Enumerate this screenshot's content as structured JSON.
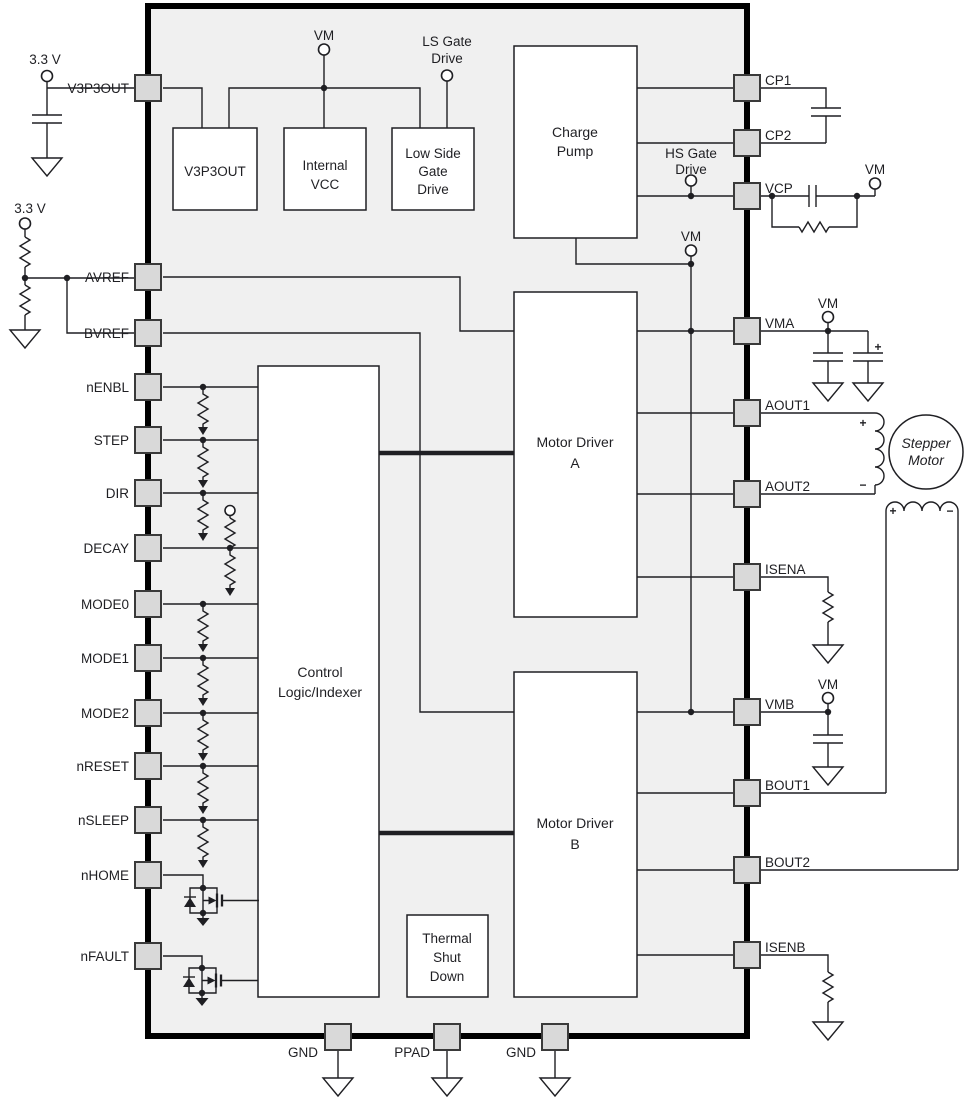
{
  "labels": {
    "v33": "3.3 V",
    "vm": "VM",
    "ls_gate": [
      "LS Gate",
      "Drive"
    ],
    "hs_gate": [
      "HS Gate",
      "Drive"
    ],
    "plus": "+",
    "minus": "−"
  },
  "blocks": {
    "v3p3out": [
      "V3P3OUT"
    ],
    "internal_vcc": [
      "Internal",
      "VCC"
    ],
    "low_side_gate_drive": [
      "Low Side",
      "Gate",
      "Drive"
    ],
    "charge_pump": [
      "Charge",
      "Pump"
    ],
    "motor_driver_a": [
      "Motor Driver",
      "A"
    ],
    "motor_driver_b": [
      "Motor Driver",
      "B"
    ],
    "control_logic": [
      "Control",
      "Logic/Indexer"
    ],
    "thermal_shutdown": [
      "Thermal",
      "Shut",
      "Down"
    ]
  },
  "pins": {
    "left": [
      "V3P3OUT",
      "AVREF",
      "BVREF",
      "nENBL",
      "STEP",
      "DIR",
      "DECAY",
      "MODE0",
      "MODE1",
      "MODE2",
      "nRESET",
      "nSLEEP",
      "nHOME",
      "nFAULT"
    ],
    "right": [
      "CP1",
      "CP2",
      "VCP",
      "VMA",
      "AOUT1",
      "AOUT2",
      "ISENA",
      "VMB",
      "BOUT1",
      "BOUT2",
      "ISENB"
    ],
    "bottom": [
      "GND",
      "PPAD",
      "GND"
    ]
  },
  "external": {
    "stepper_motor": [
      "Stepper",
      "Motor"
    ]
  },
  "colors": {
    "line": "#1f1f23",
    "chip_fill": "#f0f0f0",
    "pin_fill": "#d9d9d9",
    "block_fill": "#ffffff",
    "background": "#ffffff"
  }
}
